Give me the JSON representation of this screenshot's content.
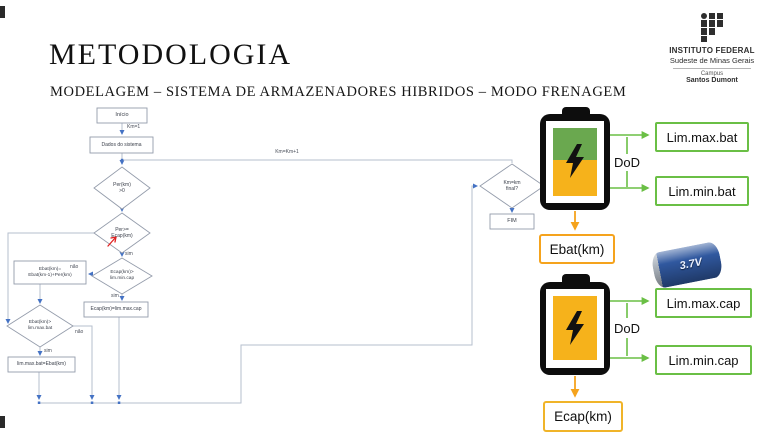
{
  "slide": {
    "title": "METODOLOGIA",
    "subtitle": "MODELAGEM – SISTEMA DE ARMAZENADORES HIBRIDOS – MODO FRENAGEM"
  },
  "logo": {
    "institution": "INSTITUTO FEDERAL",
    "region": "Sudeste de Minas Gerais",
    "campus_label": "Campus",
    "campus_name": "Santos Dumont"
  },
  "flowchart": {
    "nodes": {
      "inicio": "Início",
      "dados": "Dados do sistema",
      "per_check": "Per(km)\n>0",
      "per_ecap_check": "Per>=\nEcap(km)",
      "ecap_limit_check": "Ecap(km)>\nlim.min.cap",
      "ecap_set": "Ecap(km)=lim.max.cap",
      "ebat_update": "Ebat(km)=\nEbat(km-1)+Per(km)",
      "ebat_limit_check": "Ebat(km)>\nlim.max.bat",
      "limmax_set": "lim.max.bat=Ebat(km)",
      "km_final_check": "Km=km\nfinal?",
      "fim": "FIM"
    },
    "labels": {
      "km_init": "Km=1",
      "km_increment": "Km=Km+1",
      "yes": "sim",
      "no": "não"
    }
  },
  "storage_diagrams": {
    "battery": {
      "upper_limit": "Lim.max.bat",
      "lower_limit": "Lim.min.bat",
      "dod": "DoD",
      "energy": "Ebat(km)"
    },
    "capacitor": {
      "upper_limit": "Lim.max.cap",
      "lower_limit": "Lim.min.cap",
      "dod": "DoD",
      "energy": "Ecap(km)"
    },
    "cell_voltage": "3.7V"
  },
  "colors": {
    "limit_green": "#6abf45",
    "energy_orange": "#f5a31d",
    "battery_soc_green": "#6aa84f",
    "battery_soc_yellow": "#f6b21b",
    "connector_gray": "#b6bfce",
    "arrow_blue": "#4472c4"
  }
}
